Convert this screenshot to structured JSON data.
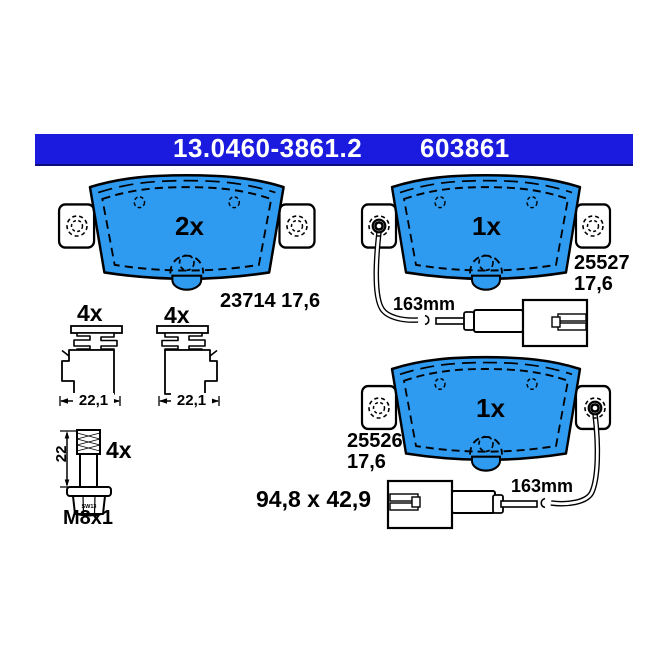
{
  "header": {
    "part_number": "13.0460-3861.2",
    "ean_short": "603861",
    "bar_color": "#1b1be0",
    "text_color": "#ffffff"
  },
  "colors": {
    "pad_fill": "#2e9af0",
    "line": "#000000",
    "background": "#ffffff"
  },
  "pads": {
    "plain": {
      "qty": "2x",
      "ref": "23714 17,6"
    },
    "upper_sensor": {
      "qty": "1x",
      "ref": "25527",
      "thickness": "17,6",
      "cable": "163mm"
    },
    "lower_sensor": {
      "qty": "1x",
      "ref": "25526",
      "thickness": "17,6",
      "cable": "163mm",
      "size": "94,8 x 42,9"
    }
  },
  "accessories": {
    "clip_left": {
      "qty": "4x",
      "width": "22,1"
    },
    "clip_right": {
      "qty": "4x",
      "width": "22,1"
    },
    "bolt": {
      "qty": "4x",
      "length": "22",
      "thread": "M8x1",
      "marking": "SW13"
    }
  }
}
